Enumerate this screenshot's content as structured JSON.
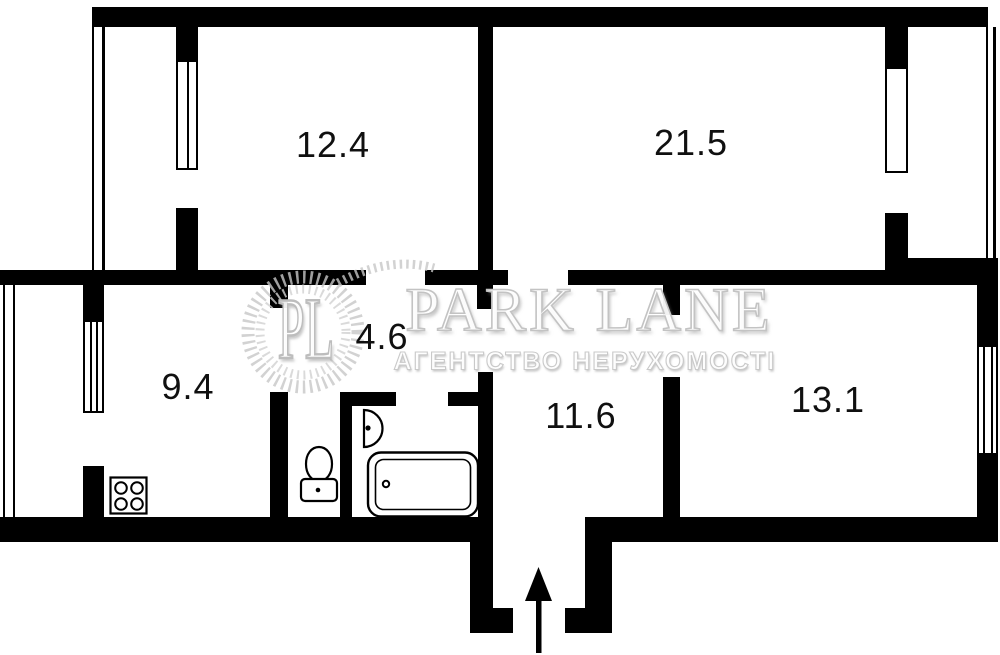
{
  "rooms": [
    {
      "area": "12.4"
    },
    {
      "area": "21.5"
    },
    {
      "area": "4.6"
    },
    {
      "area": "9.4"
    },
    {
      "area": "11.6"
    },
    {
      "area": "13.1"
    }
  ],
  "watermark": {
    "monogram": "PL",
    "brand": "PARK LANE",
    "tagline": "АГЕНТСТВО НЕРУХОМОСТІ"
  },
  "icons": [
    "stove-icon",
    "toilet-icon",
    "sink-icon",
    "bathtub-icon",
    "entrance-arrow-icon",
    "laurel-wreath-icon"
  ],
  "colors": {
    "wall": "#000000",
    "background": "#ffffff",
    "watermark_gray": "#c6c6c6",
    "label_text": "#101010"
  }
}
